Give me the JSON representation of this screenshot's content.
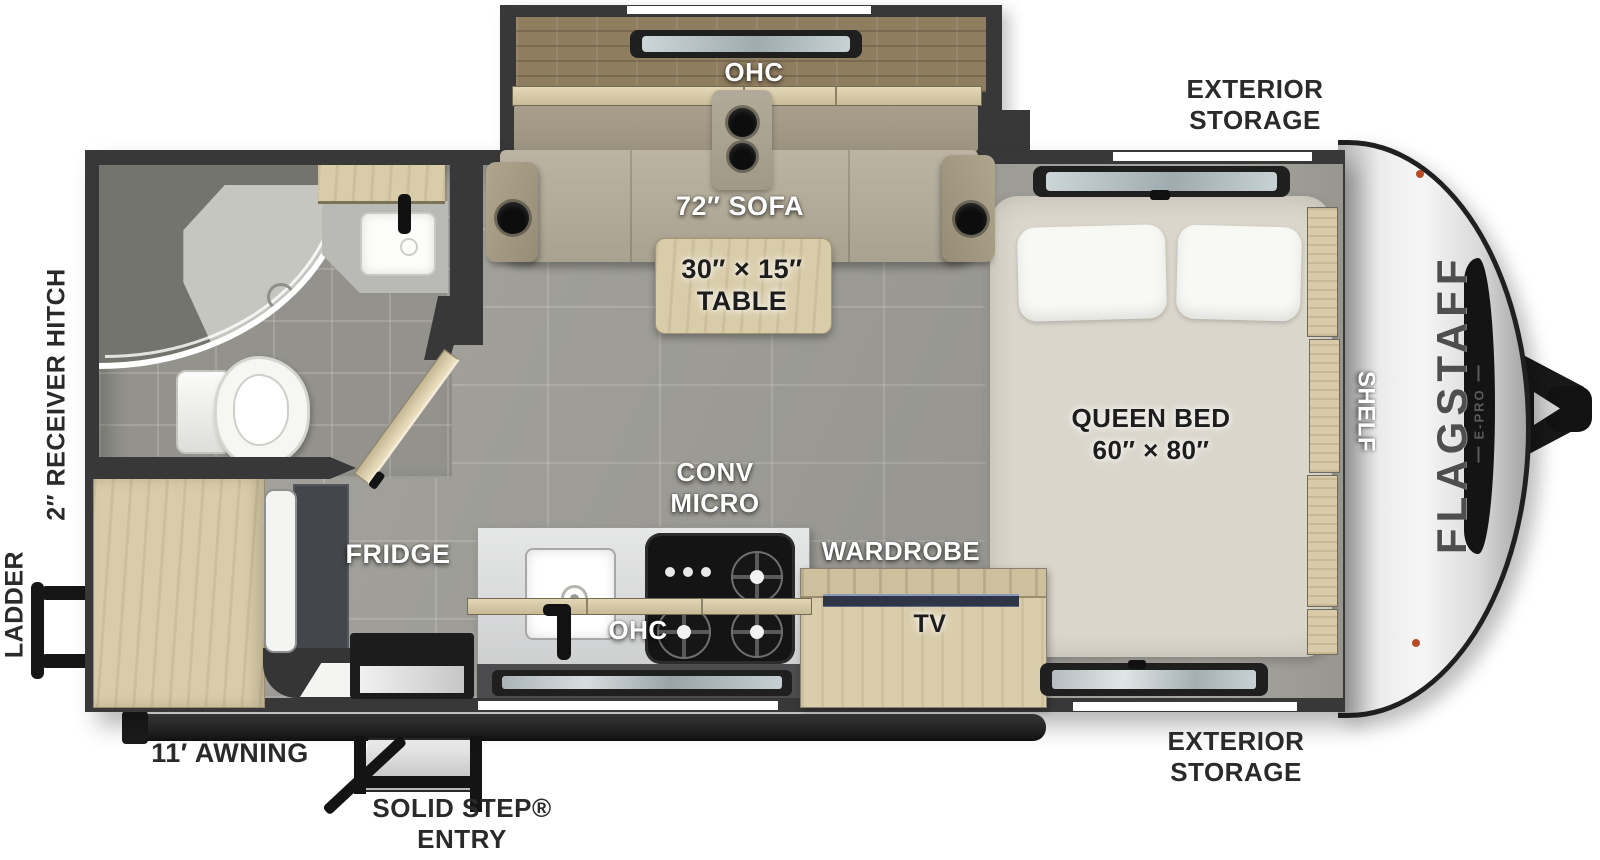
{
  "branding": {
    "model": "FLAGSTAFF",
    "trim": "E-PRO"
  },
  "labels": {
    "exterior_storage_top": {
      "l1": "EXTERIOR",
      "l2": "STORAGE"
    },
    "exterior_storage_bottom": {
      "l1": "EXTERIOR",
      "l2": "STORAGE"
    },
    "receiver_hitch": "2″ RECEIVER HITCH",
    "ladder": "LADDER",
    "awning": "11′ AWNING",
    "entry": {
      "l1": "SOLID STEP®",
      "l2": "ENTRY"
    },
    "slide_ohc": "OHC",
    "sofa": "72″ SOFA",
    "table": {
      "l1": "30″ × 15″",
      "l2": "TABLE"
    },
    "queen_bed": {
      "l1": "QUEEN BED",
      "l2": "60″ × 80″"
    },
    "shelf": "SHELF",
    "conv_micro": {
      "l1": "CONV",
      "l2": "MICRO"
    },
    "kitchen_ohc": "OHC",
    "fridge": "FRIDGE",
    "wardrobe": "WARDROBE",
    "tv": "TV"
  },
  "colors": {
    "wall": "#383838",
    "floor": "#a09f99",
    "wood": "#d9cca9",
    "sofa_fabric": "#b6ae9c",
    "mattress": "#dad6cb",
    "front_cap": "#e9e9e9",
    "marker_light": "#b84a26",
    "tv_screen": "#8b99ba"
  }
}
